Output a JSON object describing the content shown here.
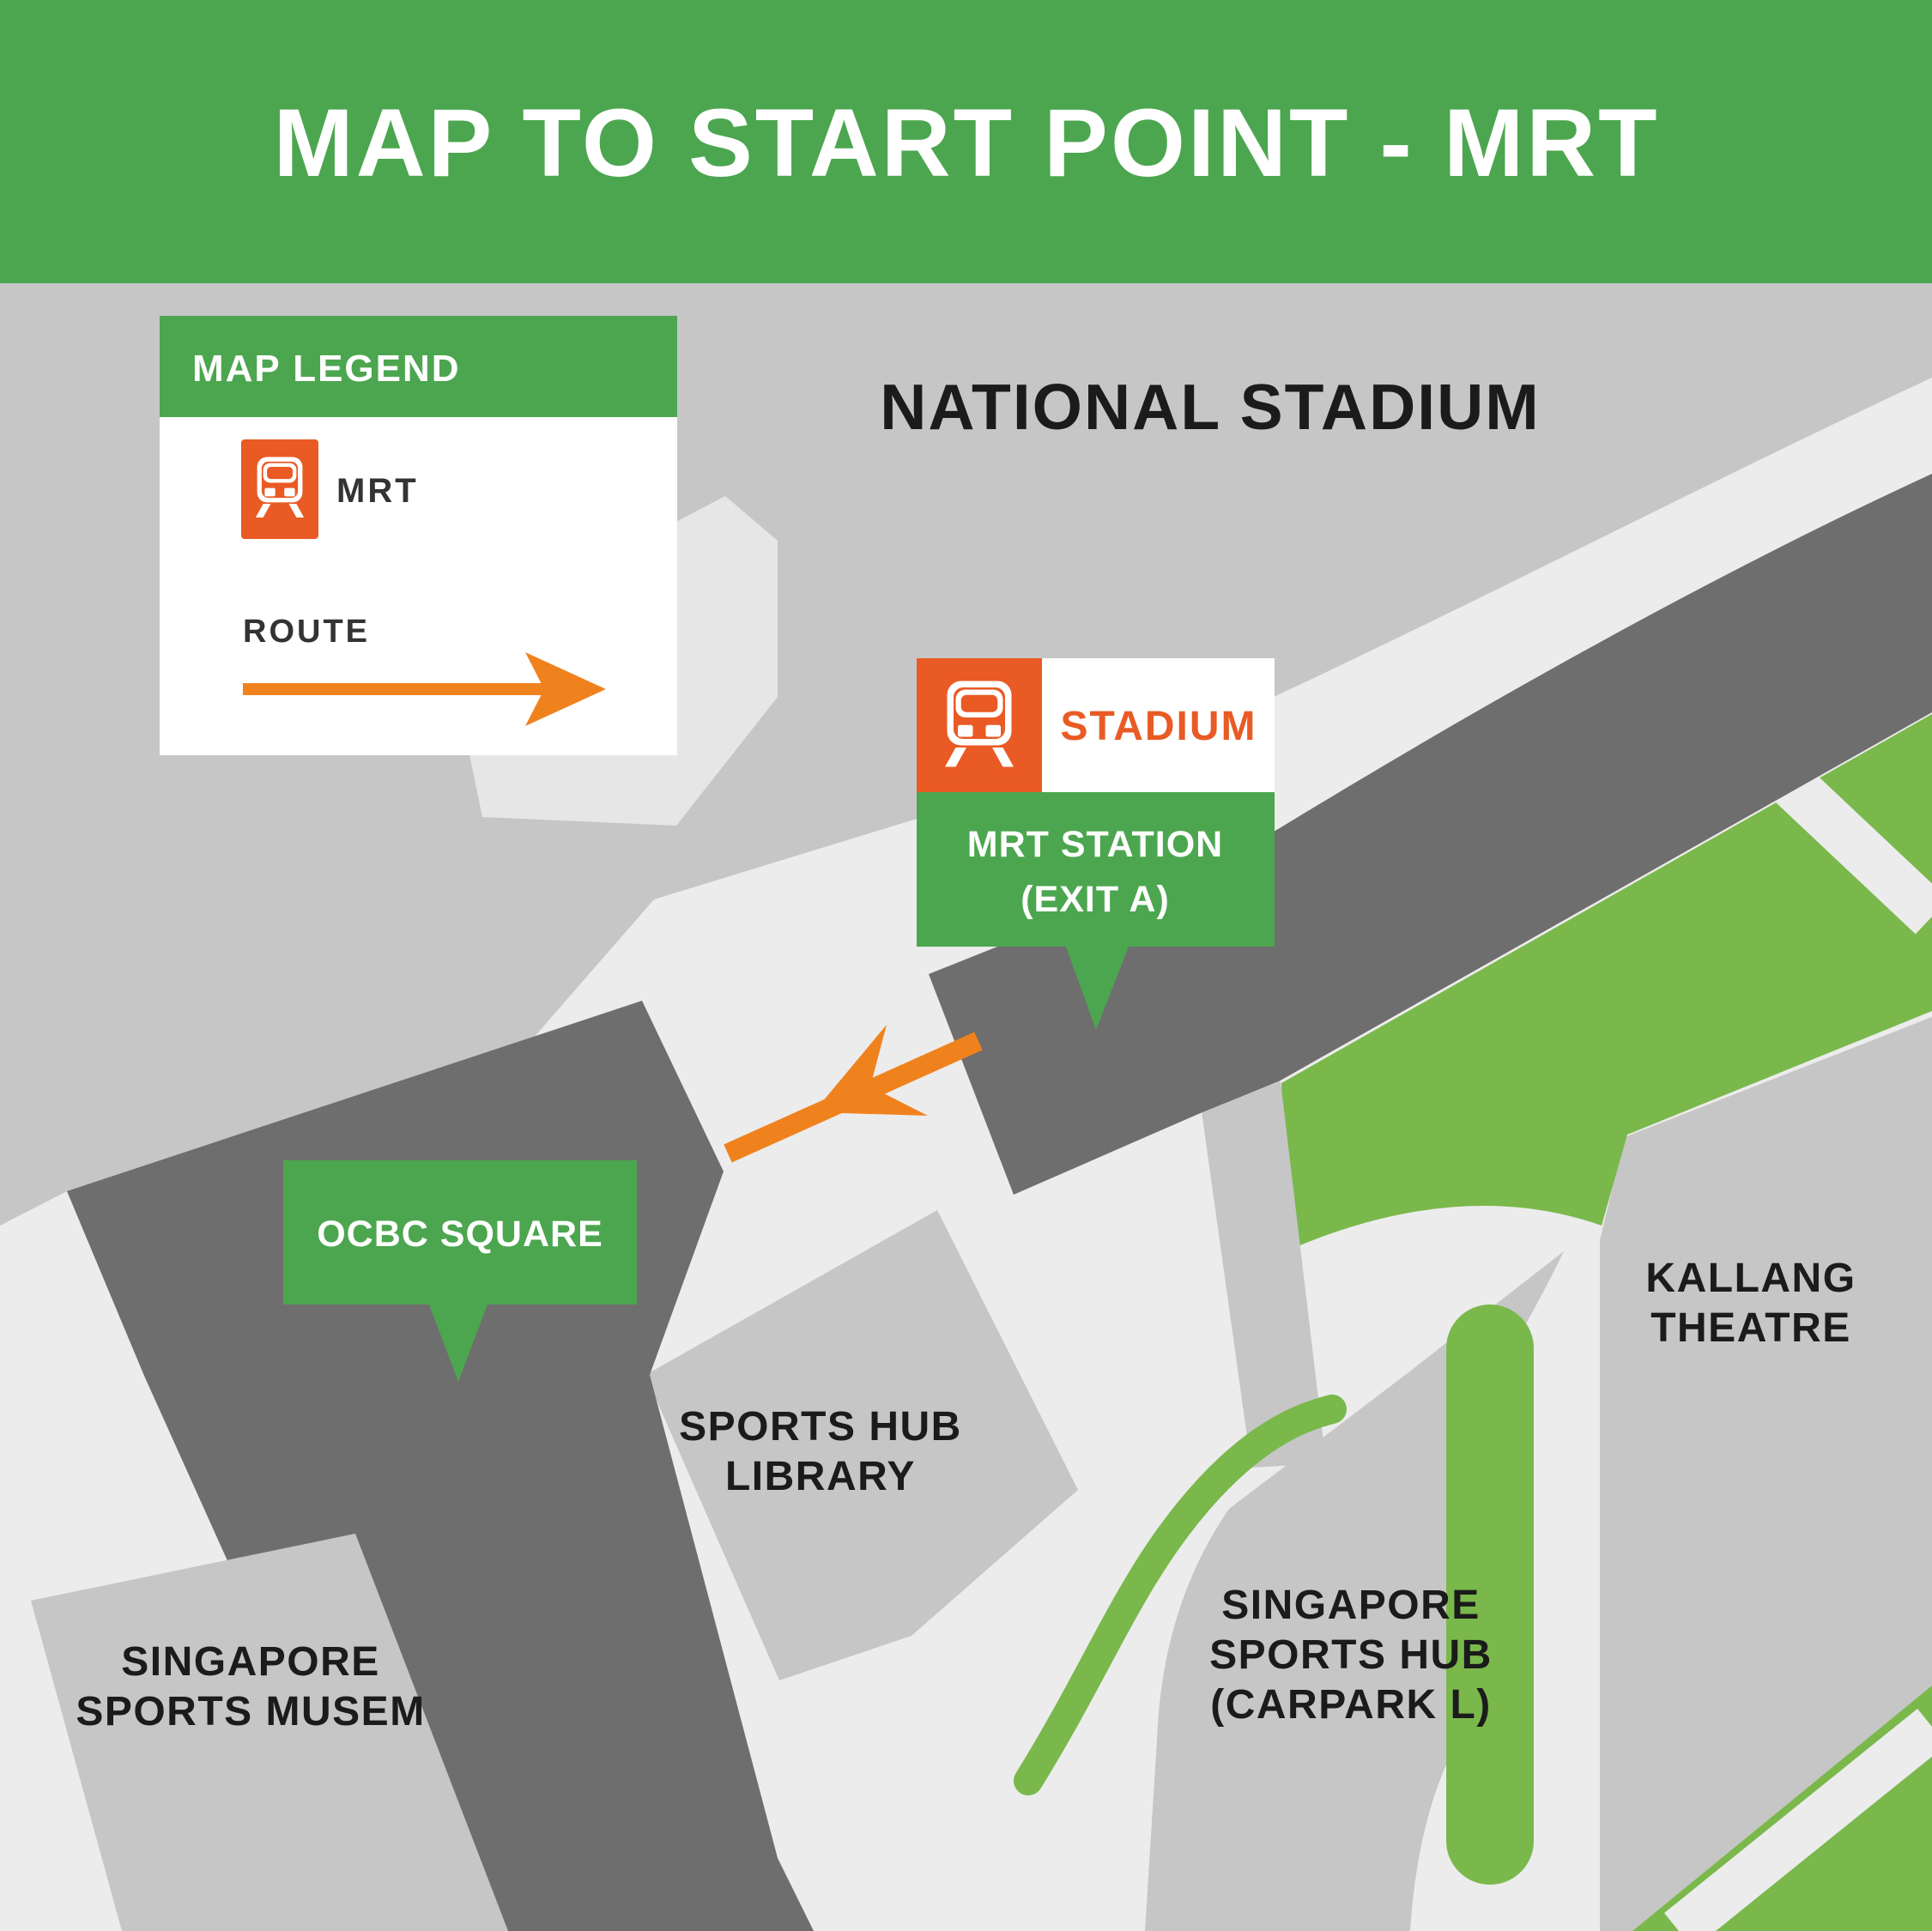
{
  "header": {
    "title": "MAP TO START POINT - MRT"
  },
  "legend": {
    "title": "MAP LEGEND",
    "mrt_label": "MRT",
    "route_label": "ROUTE",
    "mrt_icon": "train-icon",
    "route_icon": "route-arrow-icon"
  },
  "station_callout": {
    "station_name": "STADIUM",
    "line1": "MRT STATION",
    "line2": "(EXIT A)",
    "icon": "train-icon"
  },
  "ocbc_callout": {
    "label": "OCBC SQUARE"
  },
  "labels": {
    "national_stadium": "NATIONAL STADIUM",
    "kallang_theatre": [
      "KALLANG",
      "THEATRE"
    ],
    "sports_hub_library": [
      "SPORTS HUB",
      "LIBRARY"
    ],
    "singapore_sports_hub": [
      "SINGAPORE",
      "SPORTS HUB",
      "(CARPARK L)"
    ],
    "sports_museum": [
      "SINGAPORE",
      "SPORTS MUSEM"
    ]
  },
  "colors": {
    "header_green": "#4CA64F",
    "callout_green": "#4CA64F",
    "park_green": "#7AB84C",
    "route_orange": "#F0821E",
    "mrt_orange": "#E95A24",
    "building_dark_gray": "#6E6E6E",
    "block_light_gray": "#C6C6C6",
    "road_white": "#ECECEC",
    "label_black": "#1B1B1B"
  }
}
